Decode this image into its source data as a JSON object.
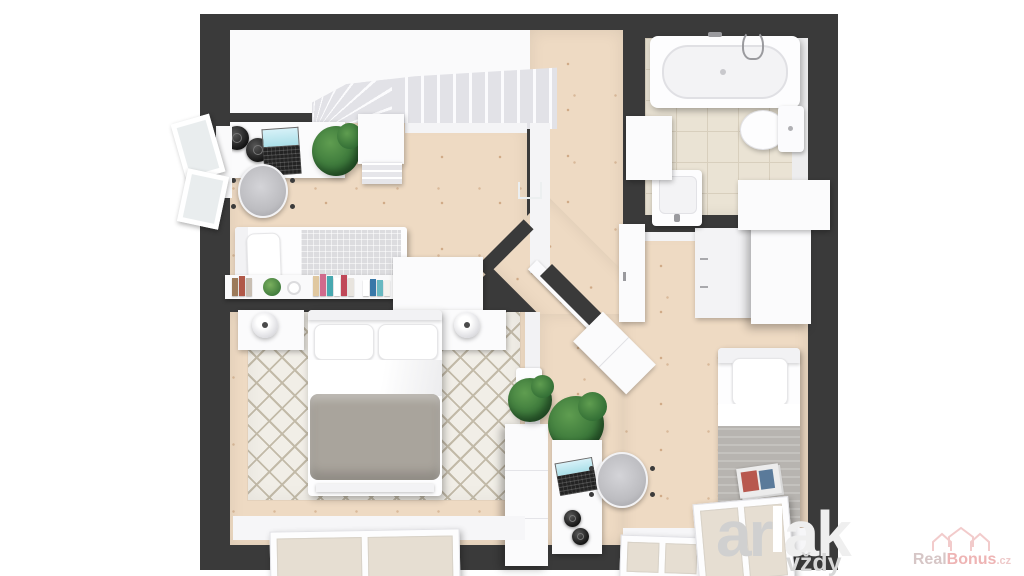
{
  "watermark": {
    "left": "ar",
    "right": "ak",
    "tagline": "vždy"
  },
  "brand": {
    "word1": "Real",
    "word2": "Bonus",
    "tld": ".cz"
  },
  "colors": {
    "wall": "#3a3a3a",
    "wood": "#eedac3",
    "tile": "#eae3d4",
    "tile_line": "#d8cfbd",
    "white": "#fbfbfc",
    "stair": "#e2e2e7",
    "rug": "#f1eee7",
    "rug_line": "#c2baa8",
    "glass_warm": "#e6ded2",
    "glass_cool": "#e9edee",
    "duvet": "#a9a49c",
    "blanket": "#b7b4b0",
    "mattress": "#dcdcdf",
    "plant_dark": "#2f6b33",
    "plant_light": "#5f9d50",
    "device": "#232323",
    "screen": "#aadfe8",
    "chair": "#bdbdc1",
    "wm_gray": "#d0d0d0",
    "wm_light": "#efefef",
    "wm_tagline": "#d8d8d8",
    "brand_gray": "#d6c6c6",
    "brand_pink": "#eeb4b4",
    "brand_pink_soft": "#eecaca"
  }
}
